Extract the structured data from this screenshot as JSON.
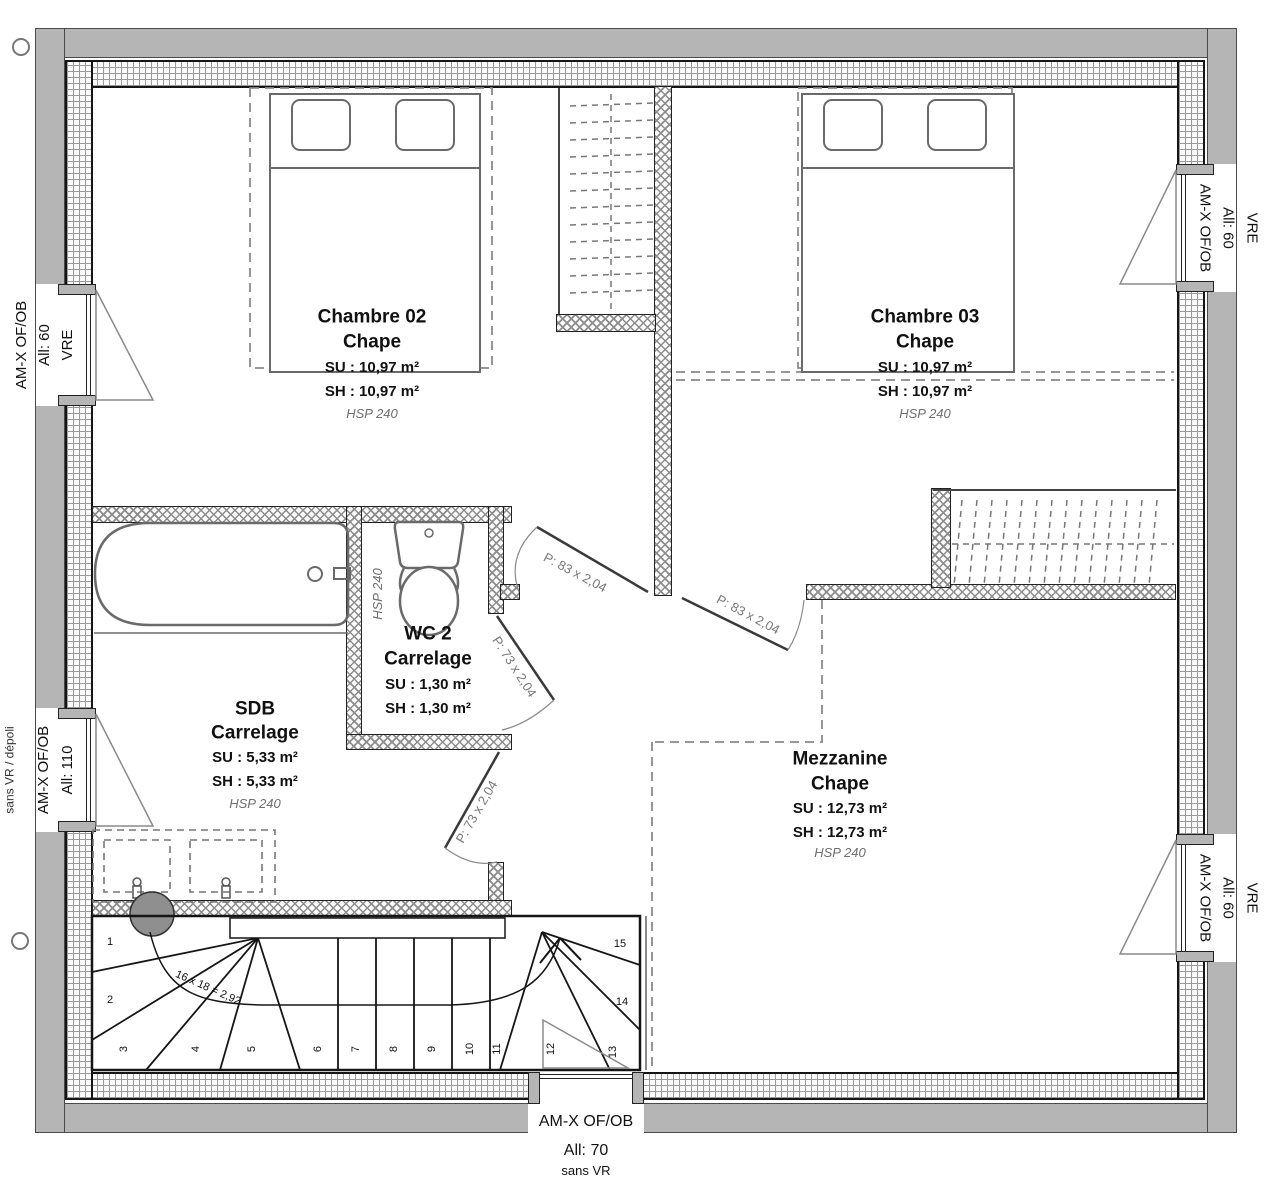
{
  "plan": {
    "rooms": [
      {
        "id": "chambre02",
        "name": "Chambre 02",
        "finish": "Chape",
        "su": "SU : 10,97 m²",
        "sh": "SH : 10,97 m²",
        "hsp": "HSP 240"
      },
      {
        "id": "chambre03",
        "name": "Chambre 03",
        "finish": "Chape",
        "su": "SU : 10,97 m²",
        "sh": "SH : 10,97 m²",
        "hsp": "HSP 240"
      },
      {
        "id": "sdb",
        "name": "SDB",
        "finish": "Carrelage",
        "su": "SU : 5,33 m²",
        "sh": "SH : 5,33 m²",
        "hsp": "HSP 240"
      },
      {
        "id": "wc2",
        "name": "WC 2",
        "finish": "Carrelage",
        "su": "SU : 1,30 m²",
        "sh": "SH : 1,30 m²",
        "hsp": "HSP 240"
      },
      {
        "id": "mezzanine",
        "name": "Mezzanine",
        "finish": "Chape",
        "su": "SU : 12,73 m²",
        "sh": "SH : 12,73 m²",
        "hsp": "HSP 240"
      }
    ],
    "windows": [
      {
        "id": "left-top",
        "line1": "AM-X OF/OB",
        "line2": "All: 60",
        "line3": "VRE"
      },
      {
        "id": "left-middle",
        "line1": "AM-X OF/OB",
        "line2": "All: 110",
        "note": "sans VR / dépoli"
      },
      {
        "id": "right-top",
        "line1": "AM-X OF/OB",
        "line2": "All: 60",
        "line3": "VRE"
      },
      {
        "id": "right-bottom",
        "line1": "AM-X OF/OB",
        "line2": "All: 60",
        "line3": "VRE"
      },
      {
        "id": "bottom",
        "line1": "AM-X OF/OB",
        "line2": "All:  70",
        "line3": "sans VR"
      }
    ],
    "doors": [
      {
        "id": "door-chambre02",
        "label": "P: 83 x 2,04"
      },
      {
        "id": "door-chambre03",
        "label": "P: 83 x 2,04"
      },
      {
        "id": "door-wc2",
        "label": "P: 73 x 2,04"
      },
      {
        "id": "door-sdb",
        "label": "P: 73 x 2,04"
      }
    ],
    "stairs": {
      "annotation": "16 x 18 = 2,92",
      "steps": [
        "1",
        "2",
        "3",
        "4",
        "5",
        "6",
        "7",
        "8",
        "9",
        "10",
        "11",
        "12",
        "13",
        "14",
        "15"
      ]
    },
    "colors": {
      "frame": "#b5b5b5",
      "wall": "#151515",
      "hatch": "#8c8c8c",
      "dash": "#8a8a8a",
      "furniture": "#6a6a6a",
      "text": "#111111",
      "muted": "#6e6e6e"
    }
  }
}
